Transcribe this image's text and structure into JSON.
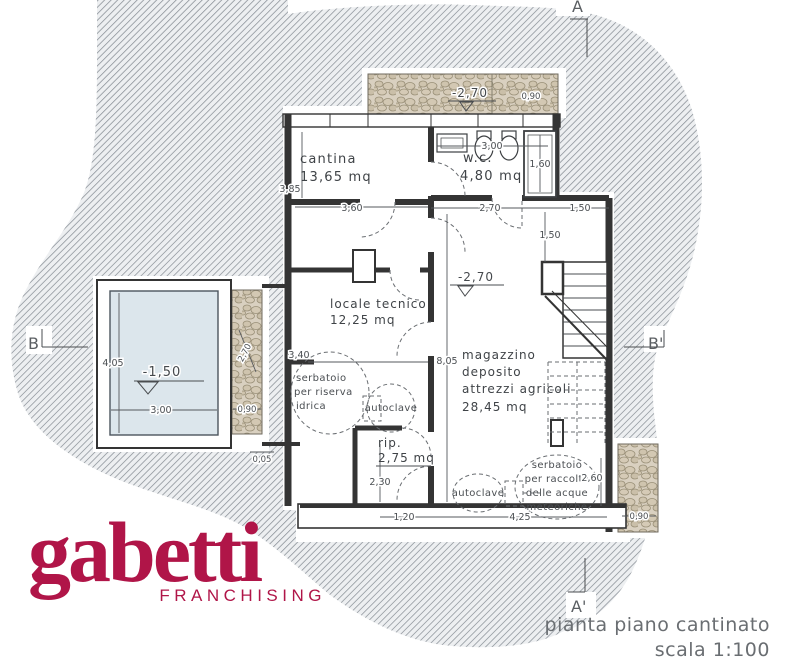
{
  "caption": {
    "title": "pianta piano cantinato",
    "scale": "scala 1:100"
  },
  "logo": {
    "brand": "gabetti",
    "subtitle": "FRANCHISING",
    "color": "#b01548"
  },
  "sections": {
    "a": "A",
    "a_prime": "A'",
    "b": "B",
    "b_prime": "B'"
  },
  "rooms": {
    "cantina": {
      "name": "cantina",
      "area": "13,65 mq"
    },
    "wc": {
      "name": "w.c.",
      "area": "4,80 mq"
    },
    "locale_tecnico": {
      "name": "locale tecnico",
      "area": "12,25 mq"
    },
    "magazzino": {
      "line1": "magazzino",
      "line2": "deposito",
      "line3": "attrezzi agricoli",
      "area": "28,45 mq"
    },
    "ripostiglio": {
      "name": "rip.",
      "area": "2,75 mq"
    }
  },
  "equipment": {
    "serbatoio_riserva": {
      "line1": "serbatoio",
      "line2": "per riserva",
      "line3": "idrica"
    },
    "autoclave_left": {
      "label": "autoclave"
    },
    "autoclave_right": {
      "label": "autoclave"
    },
    "serbatoio_meteoriche": {
      "line1": "serbatoio",
      "line2": "per raccolta",
      "line3": "delle acque",
      "line4": "meteoriche"
    }
  },
  "levels": {
    "terrace": "-2,70",
    "magazzino": "-2,70",
    "pool": "-1,50"
  },
  "dims": {
    "cantina_height": "3,85",
    "cantina_width": "3,60",
    "wc_width": "3,00",
    "shower_depth": "1,60",
    "below_wc": "2,70",
    "top_right": "1,50",
    "stair_landing": "1,50",
    "terrace_right": "0,90",
    "left_mid": "3,40",
    "magazzino_height": "8,05",
    "rip_height": "2,30",
    "bottom_left": "1,20",
    "bottom_center": "4,25",
    "meteo_right": "2,60",
    "pool_height": "4,05",
    "pool_width": "3,00",
    "pool_wall": "0,90",
    "pool_wall_depth": "2,70",
    "pool_base": "0,05",
    "patch_bottom_right": "0,90"
  }
}
